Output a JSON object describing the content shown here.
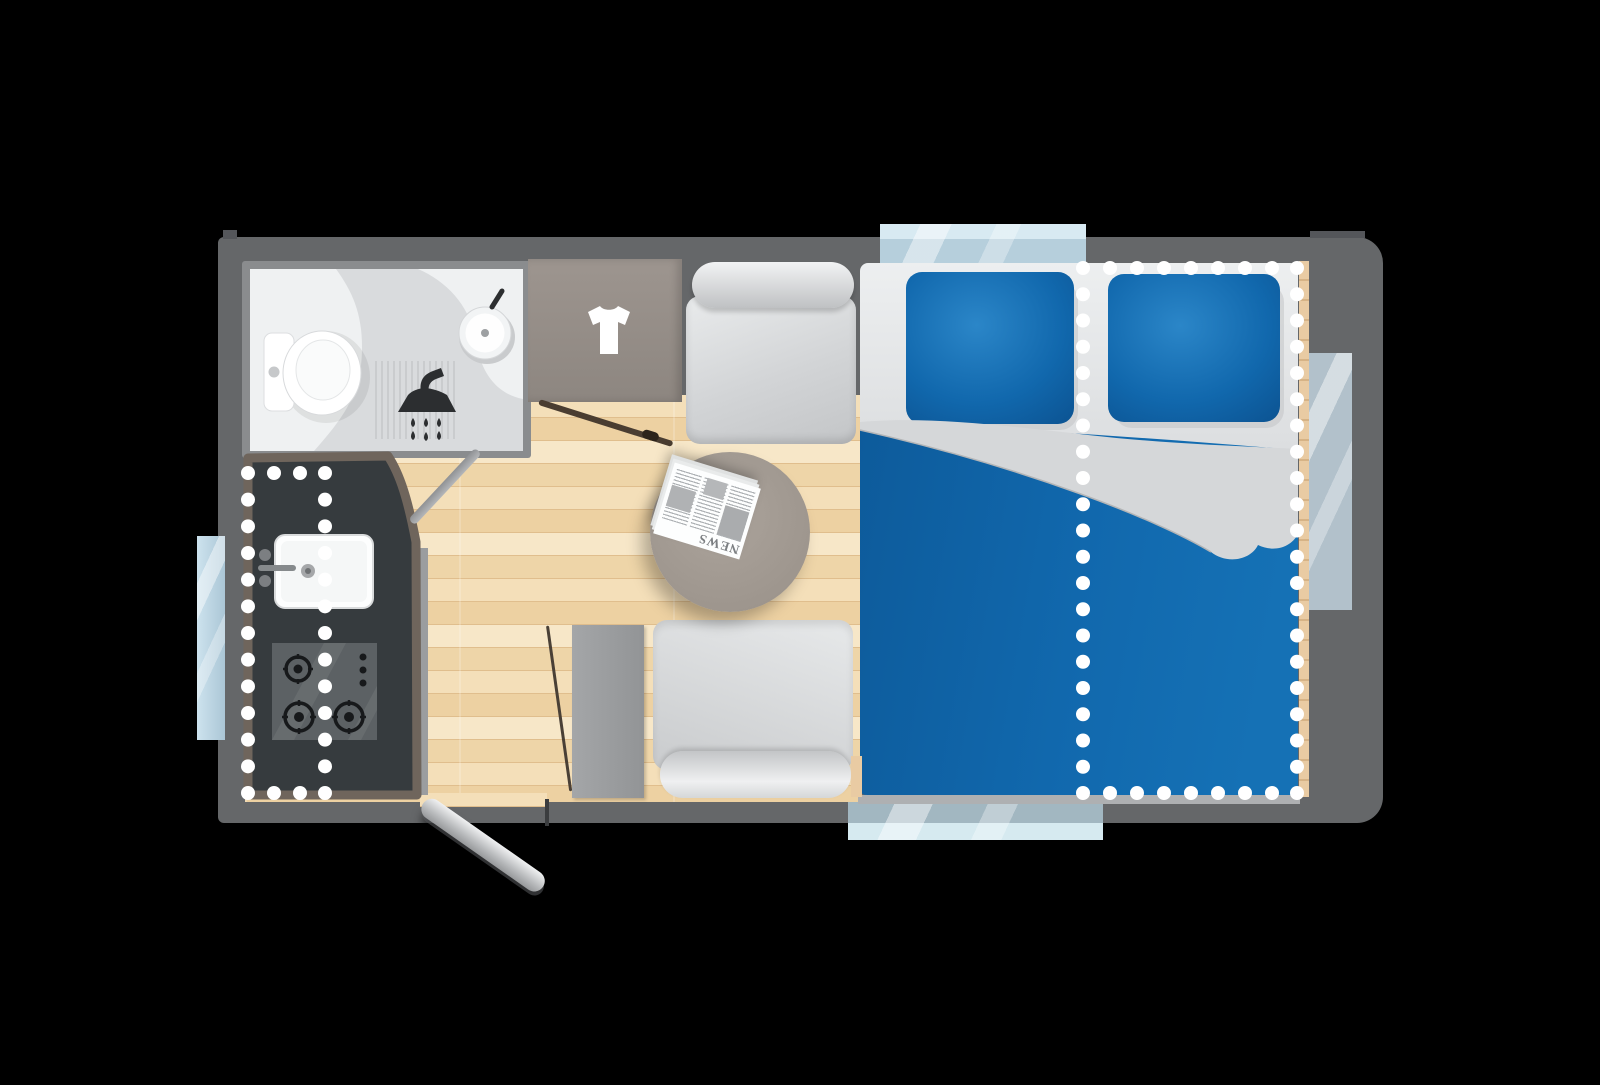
{
  "title": "Caravan floor plan — top view",
  "newspaper": {
    "masthead": "NEWS"
  },
  "icons": {
    "bathroom": [
      "toilet-icon",
      "shower-icon",
      "washbasin-icon"
    ],
    "wardrobe": "tshirt-icon",
    "kitchen": [
      "sink-icon",
      "hob-icon",
      "burner-icon"
    ],
    "lounge": [
      "round-table-icon",
      "newspaper-icon",
      "bench-seat-icon"
    ],
    "bedroom": [
      "double-bed-icon",
      "pillow-icon",
      "fold-out-dotted-outline"
    ]
  },
  "palette": {
    "body": "#656769",
    "wall": "#8a8c8e",
    "floor": "#f1d9ae",
    "counter": "#363b3e",
    "counterEdge": "#6f655c",
    "duvet": "#1168ad",
    "pillow": "#1471b4",
    "mattress": "#d6d8da",
    "window": "#bdd7e4",
    "table": "#a39b93",
    "wardrobe": "#97908a",
    "dots": "#ffffff"
  }
}
